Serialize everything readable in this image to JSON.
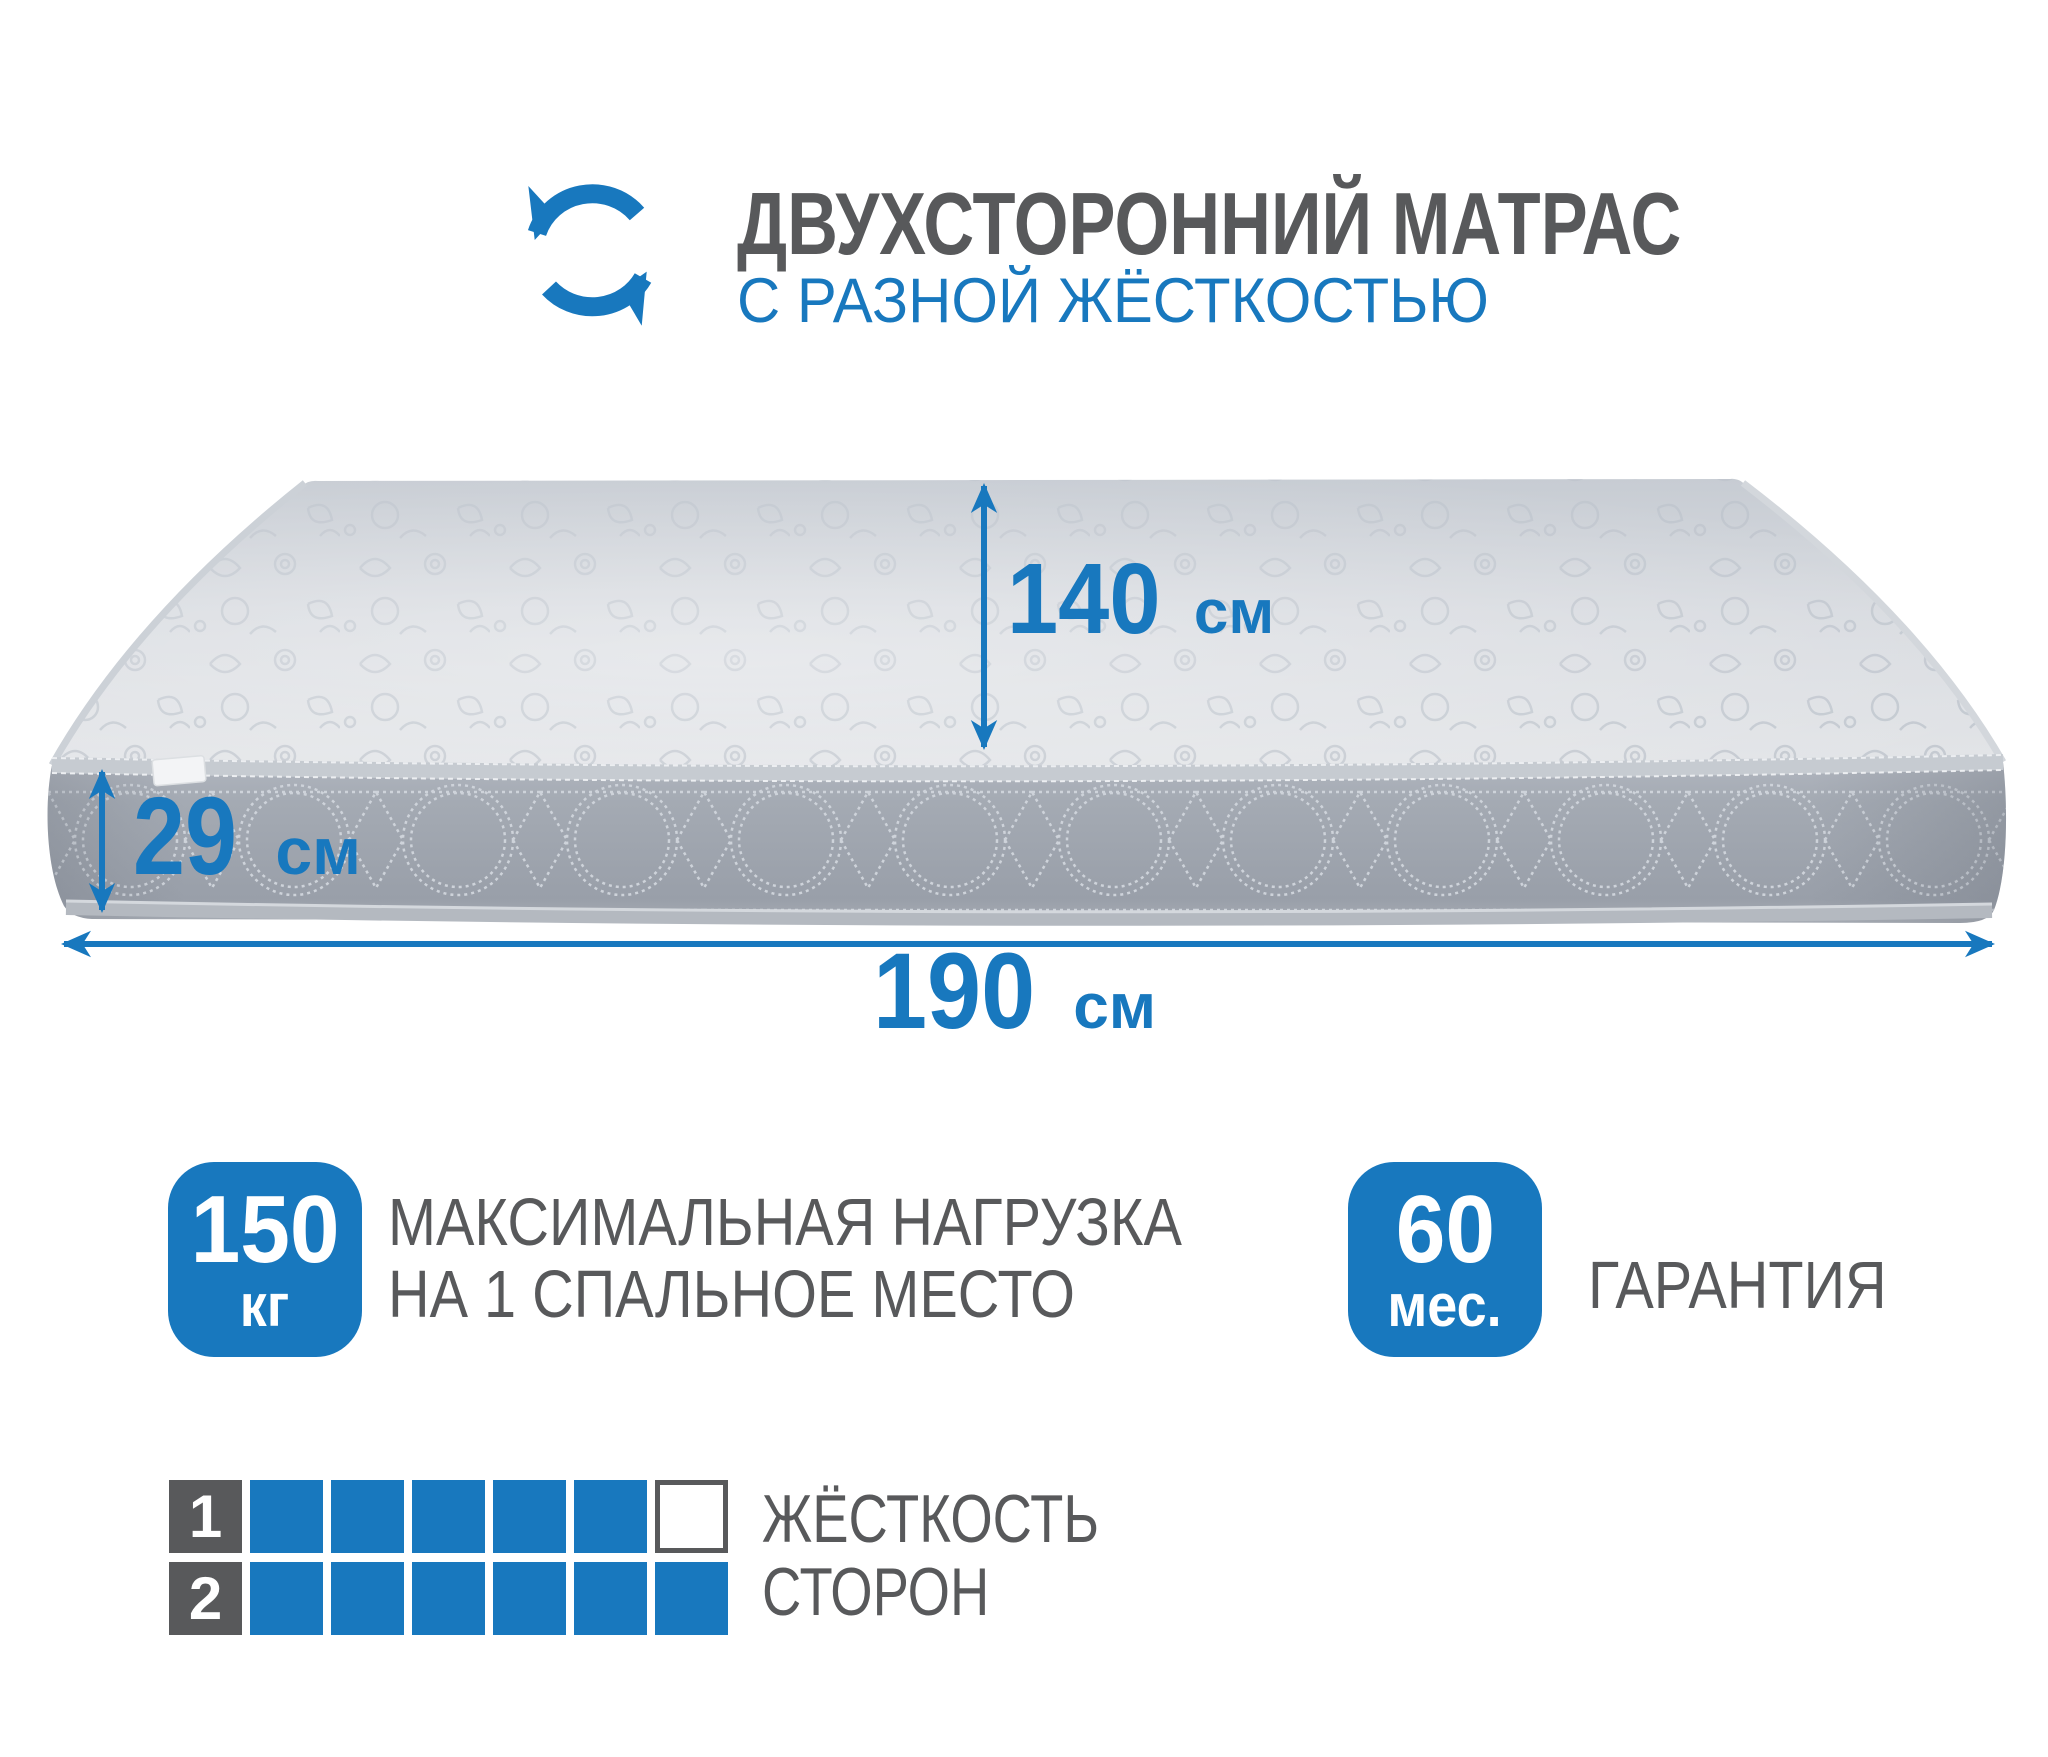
{
  "colors": {
    "accent_blue": "#1878be",
    "text_gray": "#58595b",
    "mattress_top": "#d9dce1",
    "mattress_side": "#9ea4ae",
    "background": "#ffffff"
  },
  "header": {
    "icon": "rotate-arrows",
    "title_line1": "ДВУХСТОРОННИЙ МАТРАС",
    "title_line2": "С РАЗНОЙ ЖЁСТКОСТЬЮ"
  },
  "dimensions": {
    "width": {
      "value": "140",
      "unit": "см"
    },
    "height": {
      "value": "29",
      "unit": "см"
    },
    "length": {
      "value": "190",
      "unit": "см"
    }
  },
  "features": [
    {
      "badge_value": "150",
      "badge_unit": "кг",
      "label_line1": "МАКСИМАЛЬНАЯ НАГРУЗКА",
      "label_line2": "НА 1 СПАЛЬНОЕ МЕСТО"
    },
    {
      "badge_value": "60",
      "badge_unit": "мес.",
      "label_line1": "ГАРАНТИЯ",
      "label_line2": ""
    }
  ],
  "firmness": {
    "caption_line1": "ЖЁСТКОСТЬ",
    "caption_line2": "СТОРОН",
    "rows": [
      {
        "label": "1",
        "filled": 5,
        "total": 6
      },
      {
        "label": "2",
        "filled": 6,
        "total": 6
      }
    ]
  }
}
